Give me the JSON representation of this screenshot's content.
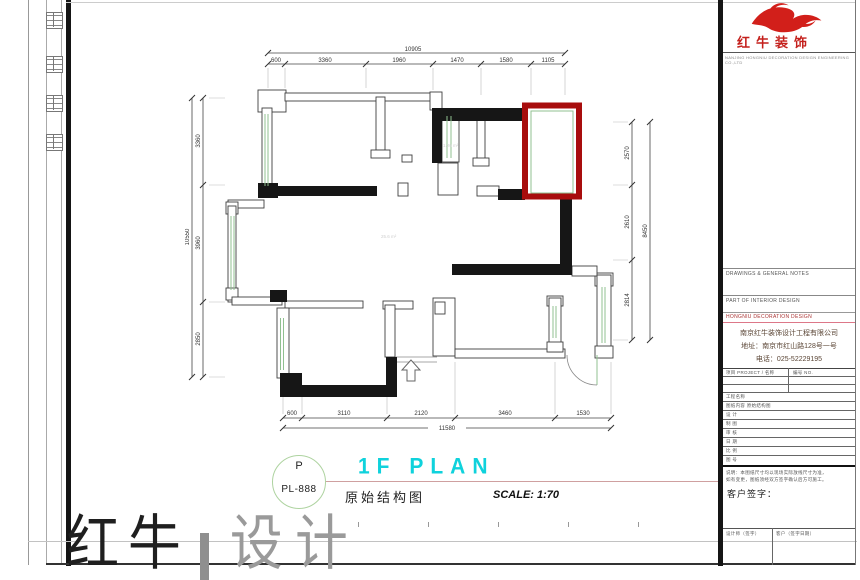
{
  "brand": {
    "name": "红牛装饰",
    "tagline": "NANJING HONGNIU DECORATION DESIGN ENGINEERING CO.,LTD"
  },
  "dimensions": {
    "top": {
      "total": "10905",
      "segments": [
        "600",
        "3360",
        "1960",
        "1470",
        "1580",
        "1105"
      ]
    },
    "bottom": {
      "total": "11580",
      "segments": [
        "600",
        "3110",
        "2120",
        "3460",
        "1530"
      ]
    },
    "left": {
      "total": "10550",
      "segments": [
        "3360",
        "3960",
        "2850"
      ]
    },
    "right": {
      "total": "8450",
      "segments": [
        "2570",
        "2610",
        "2814"
      ]
    }
  },
  "plan": {
    "room_labels": [
      "1.26 m²",
      "25.6 m²"
    ]
  },
  "titlebar": {
    "circle_letter": "P",
    "sheet_no": "PL-888",
    "title": "1F PLAN",
    "subtitle": "原始结构图",
    "scale": "SCALE: 1:70"
  },
  "watermark": {
    "left": "红牛",
    "right": "设计"
  },
  "titleblock": {
    "section1": "DRAWINGS & GENERAL NOTES",
    "section2": "PART OF INTERIOR DESIGN",
    "company_header": "HONGNIU DECORATION DESIGN",
    "company": {
      "name": "南京红牛装饰设计工程有限公司",
      "address": "地址：南京市红山路128号一号",
      "phone": "电话：025-52229195"
    },
    "table_header_left": "项目 PROJECT  /  名称",
    "table_header_right": "编号 NO.",
    "rows": [
      "工程名称",
      "图纸内容  原始结构图",
      "设  计",
      "制  图",
      "审  核",
      "日  期",
      "比  例",
      "图  号"
    ],
    "notes": [
      "说明：本图纸尺寸均以现场实际放线尺寸为准，",
      "如有变更，图纸须经双方签字确认后方可施工。"
    ],
    "sign_label": "客户签字：",
    "footer_left": "设计师（签字）",
    "footer_right": "客户（签字日期）"
  }
}
